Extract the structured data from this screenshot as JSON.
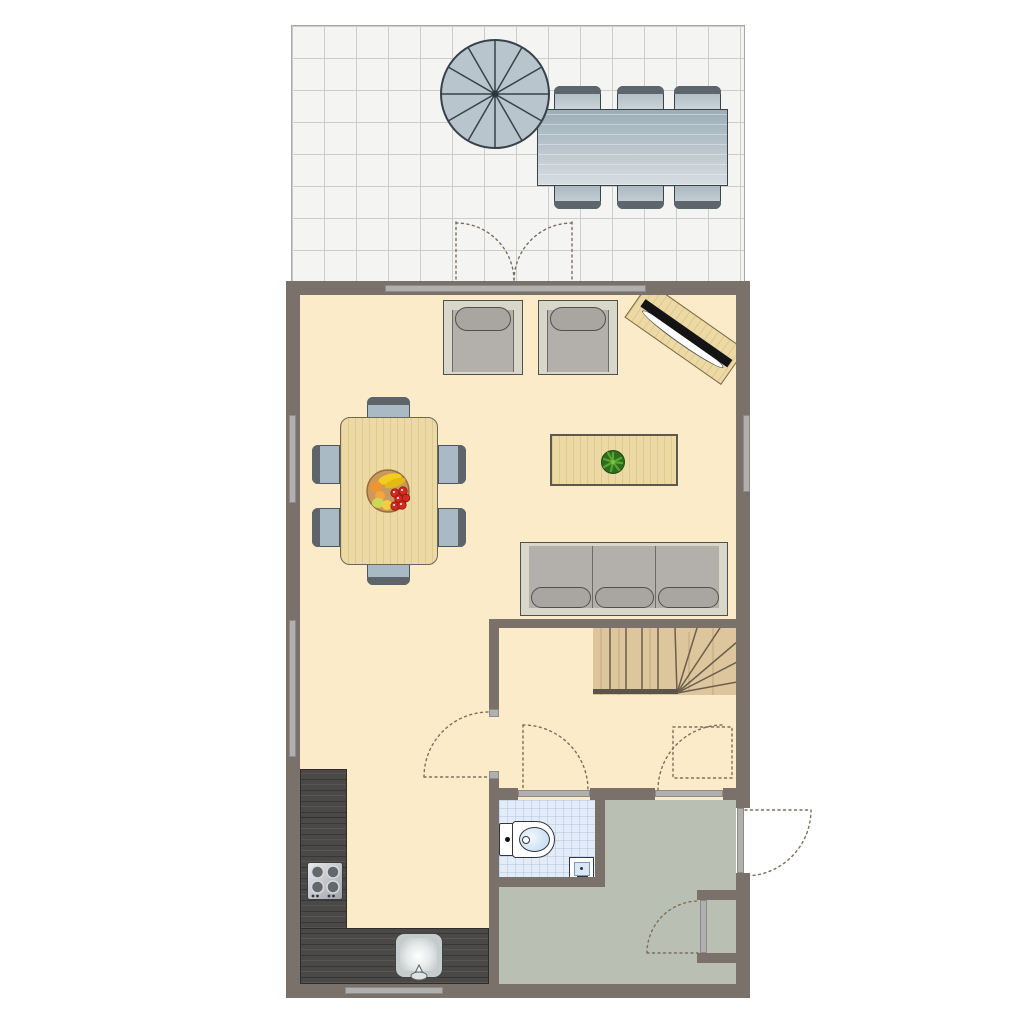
{
  "app": {
    "type": "architectural-floor-plan",
    "floor": "ground-floor"
  },
  "palette": {
    "wall": "#7a716b",
    "floor_cream": "#fcebc9",
    "floor_sage": "#b9c0b3",
    "floor_bath": "#e4edf7",
    "terrace_bg": "#f4f4f3",
    "terrace_grid": "#cccccc",
    "window_strip": "#b2b0ae",
    "wood_table": "#ecd9a4",
    "wood_stairs": "#ddc59e",
    "counter_dark": "#4b4947",
    "outline_dark": "#39444a",
    "frame_light": "#d8d8ca",
    "seat_gray": "#b3b0ab",
    "cushion_gray": "#a9a6a1",
    "chair_seat": "#a9bac5",
    "chair_back": "#5d656b",
    "plant_dark": "#2f6d1d",
    "plant_light": "#58a62e",
    "door_arc": "#7c6f5c",
    "tv_black": "#141414"
  },
  "rooms": [
    {
      "name": "terrace"
    },
    {
      "name": "living-dining-room"
    },
    {
      "name": "kitchen"
    },
    {
      "name": "hallway"
    },
    {
      "name": "bathroom"
    },
    {
      "name": "entrance-hall"
    },
    {
      "name": "closet"
    }
  ],
  "furniture": {
    "terrace": [
      "parasol",
      "outdoor-dining-table",
      "outdoor-chairs-x6"
    ],
    "living_dining": [
      "armchair-x2",
      "tv-sideboard",
      "dining-table",
      "dining-chairs-x6",
      "fruit-bowl",
      "coffee-table",
      "potted-plant",
      "sofa-3-seat"
    ],
    "kitchen": [
      "l-shaped-counter",
      "cooktop-4-burners",
      "kitchen-sink"
    ],
    "bathroom": [
      "toilet",
      "hand-basin"
    ],
    "circulation": [
      "winder-staircase"
    ]
  },
  "openings": {
    "doors": [
      "terrace-french-doors",
      "living-room-door",
      "bathroom-door",
      "hallway-door",
      "front-door",
      "side-entrance-door"
    ],
    "windows": [
      "top-wall-window",
      "left-wall-window-upper",
      "left-wall-window-lower",
      "right-wall-window",
      "kitchen-rear-window"
    ]
  },
  "counts": {
    "outdoor_chairs": 6,
    "dining_chairs": 6,
    "sofa_seats": 3,
    "armchairs": 2,
    "cooktop_burners": 4,
    "parasol_segments": 12
  }
}
